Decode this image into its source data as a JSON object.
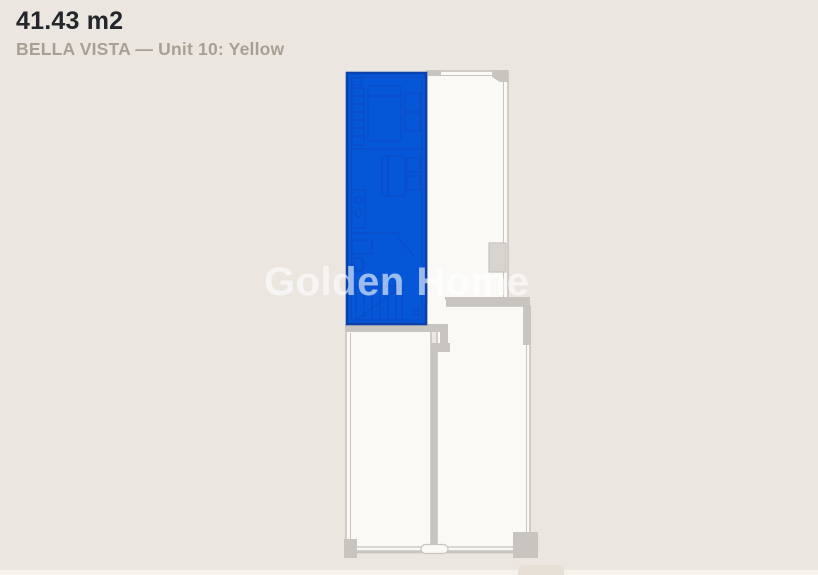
{
  "header": {
    "area": "41.43 m2",
    "project_unit": "BELLA VISTA — Unit 10: Yellow"
  },
  "watermark": "Golden Home",
  "theme": {
    "bg": "#ebe7e0",
    "room": "#fbf9f6",
    "wall": "#c8c4bf",
    "wall-lt": "#d8d4cf",
    "accent": "#0657d8",
    "accent-dk": "#0a41ac",
    "accent-line": "#0b49c4",
    "title": "#24262b",
    "subtitle": "#a9a095",
    "watermark": "rgba(255,255,255,0.6)",
    "strip": "#f6f2ec",
    "peek": "#e7e0d7"
  }
}
